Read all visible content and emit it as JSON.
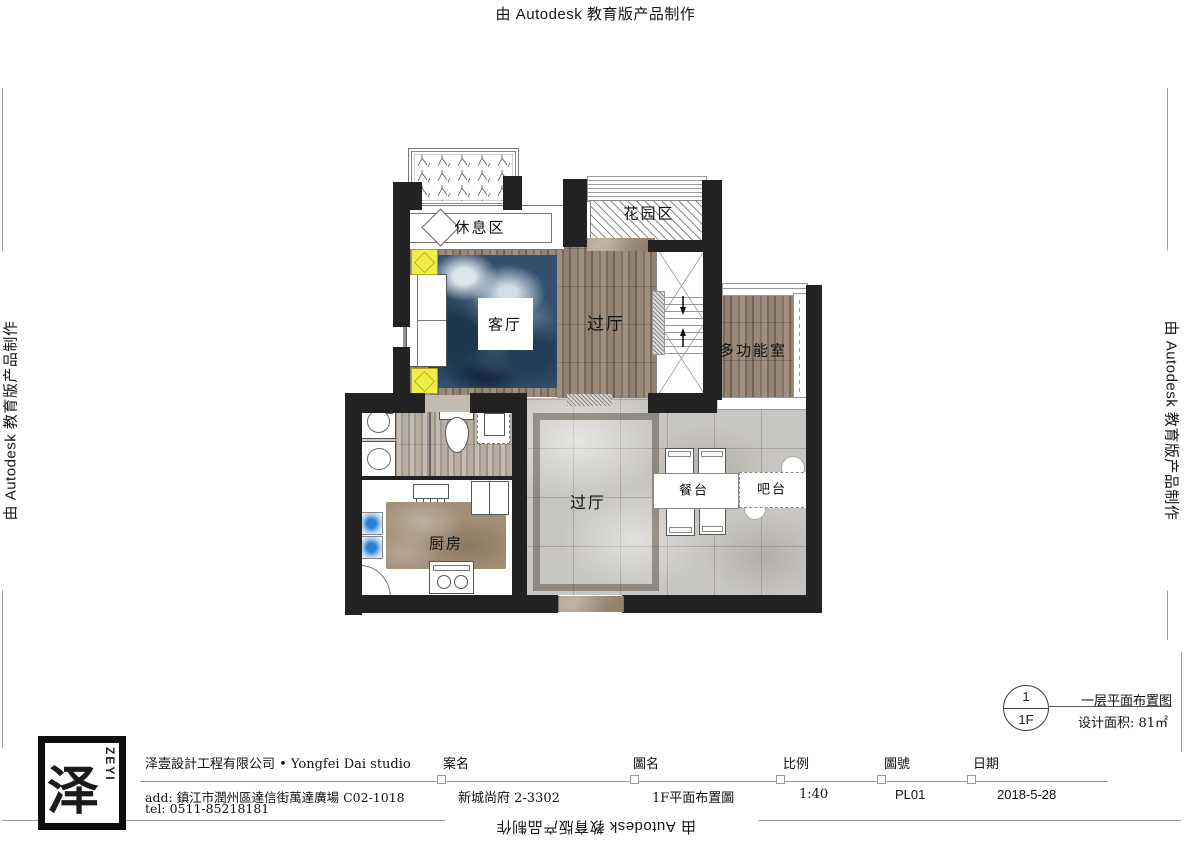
{
  "watermark": {
    "text": "由 Autodesk 教育版产品制作"
  },
  "plan": {
    "labels": {
      "rest_area": "休息区",
      "garden_area": "花园区",
      "living_room": "客厅",
      "hall_upper": "过厅",
      "multi_function_room": "多功能室",
      "hall_lower": "过厅",
      "kitchen": "厨房",
      "dining_table": "餐台",
      "bar_counter": "吧台"
    }
  },
  "title_block": {
    "logo": {
      "glyph": "泽",
      "brand": "ZEYI"
    },
    "company": "泽壹設計工程有限公司 • Yongfei Dai studio",
    "address": "add: 鎮江市潤州區達信街萬達廣場 C02-1018",
    "phone": "tel: 0511-85218181",
    "fields": [
      {
        "label": "案名",
        "value": "新城尚府 2-3302"
      },
      {
        "label": "圖名",
        "value": "1F平面布置圖"
      },
      {
        "label": "比例",
        "value": "1:40"
      },
      {
        "label": "圖號",
        "value": "PL01"
      },
      {
        "label": "日期",
        "value": "2018-5-28"
      }
    ]
  },
  "detail_marker": {
    "number": "1",
    "floor": "1F",
    "drawing_title": "一层平面布置图",
    "design_area": "设计面积: 81㎡"
  },
  "colors": {
    "wall": "#222222",
    "wood_dark": "#8d7b69",
    "wood_light": "#b3a99d",
    "marble_grey": "#c8c6c2",
    "marble_brown": "#a28f78",
    "rug_blue": "#33506e",
    "light_yellow": "#ecf046",
    "faucet_blue": "#2f7fd6"
  }
}
